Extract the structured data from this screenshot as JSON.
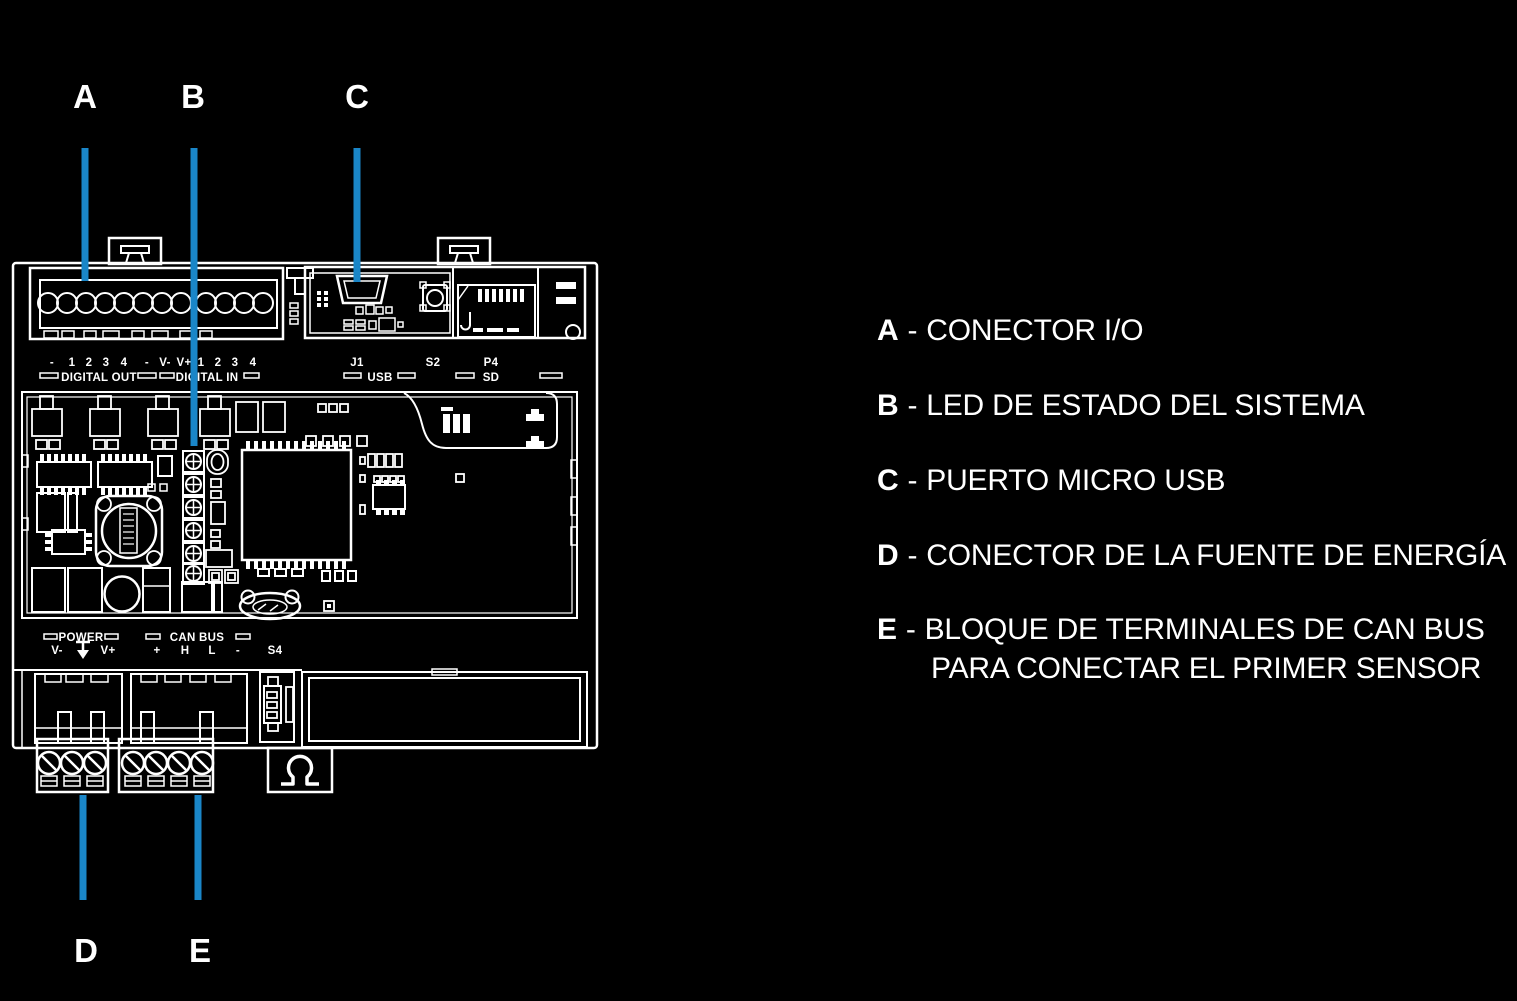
{
  "colors": {
    "background": "#000000",
    "line": "#ffffff",
    "callout_line": "#1a86c8"
  },
  "callouts": {
    "a": "A",
    "b": "B",
    "c": "C",
    "d": "D",
    "e": "E"
  },
  "legend": {
    "separator": "-",
    "items": [
      {
        "letter": "A",
        "text": "CONECTOR I/O"
      },
      {
        "letter": "B",
        "text": "LED DE ESTADO DEL SISTEMA"
      },
      {
        "letter": "C",
        "text": "PUERTO MICRO USB"
      },
      {
        "letter": "D",
        "text": "CONECTOR DE LA FUENTE DE ENERGÍA"
      },
      {
        "letter": "E",
        "text": "BLOQUE DE TERMINALES DE CAN BUS",
        "text2": "PARA CONECTAR EL PRIMER SENSOR"
      }
    ]
  },
  "device": {
    "io_pin_labels": [
      "-",
      "1",
      "2",
      "3",
      "4",
      "-",
      "V-",
      "V+",
      "1",
      "2",
      "3",
      "4"
    ],
    "digital_out": "DIGITAL OUT",
    "digital_in": "DIGITAL IN",
    "j1": "J1",
    "usb": "USB",
    "s2": "S2",
    "p4": "P4",
    "sd": "SD",
    "power": "POWER",
    "can_bus": "CAN BUS",
    "power_pin_labels": [
      "V-",
      "V+"
    ],
    "can_pin_labels": [
      "+",
      "H",
      "L",
      "-"
    ],
    "s4": "S4"
  }
}
